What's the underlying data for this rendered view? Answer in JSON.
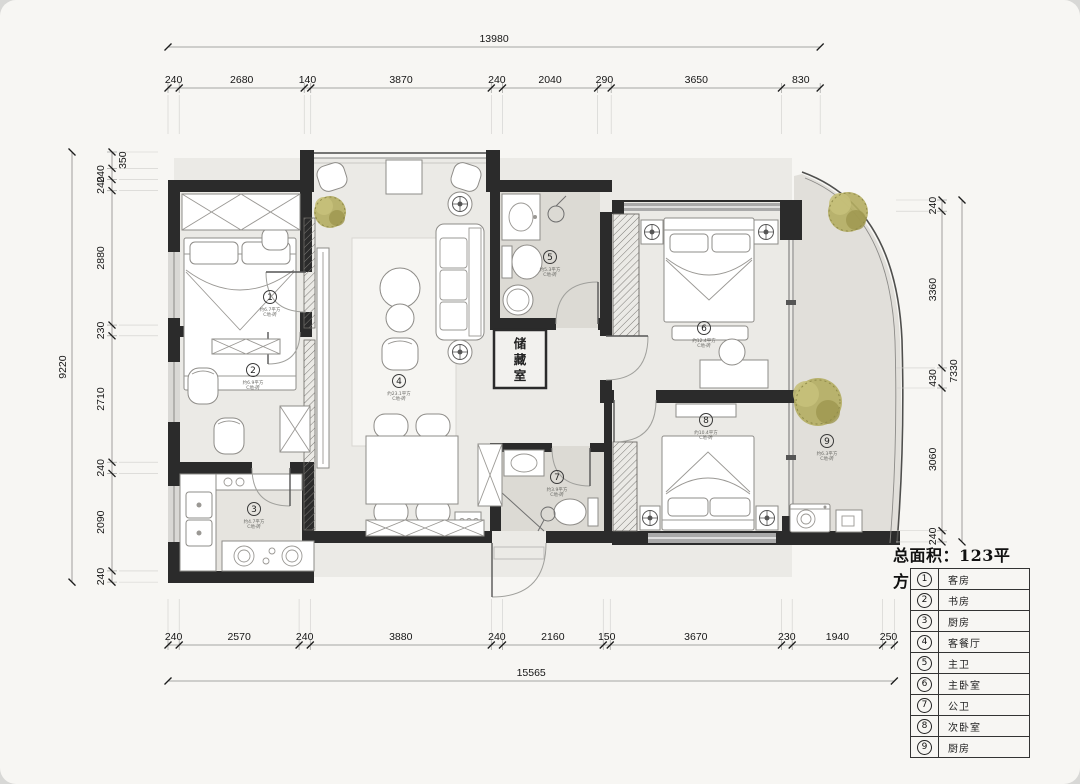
{
  "dimensions": {
    "top": {
      "overall": "13980",
      "segments": [
        "240",
        "2680",
        "140",
        "3870",
        "240",
        "2040",
        "290",
        "3650",
        "830"
      ]
    },
    "bottom": {
      "overall": "15565",
      "segments": [
        "240",
        "2570",
        "240",
        "3880",
        "240",
        "2160",
        "150",
        "3670",
        "230",
        "1940",
        "250"
      ]
    },
    "left": {
      "overall": "9220",
      "segments": [
        "350",
        "240",
        "240",
        "2880",
        "230",
        "2710",
        "240",
        "2090",
        "240"
      ]
    },
    "right": {
      "overall": "7330",
      "segments": [
        "240",
        "3360",
        "430",
        "3060",
        "240"
      ]
    }
  },
  "legend": {
    "total_line1": "总面积：123平",
    "total_line2": "方",
    "rows": [
      {
        "num": "1",
        "name": "客房"
      },
      {
        "num": "2",
        "name": "书房"
      },
      {
        "num": "3",
        "name": "厨房"
      },
      {
        "num": "4",
        "name": "客餐厅"
      },
      {
        "num": "5",
        "name": "主卫"
      },
      {
        "num": "6",
        "name": "主卧室"
      },
      {
        "num": "7",
        "name": "公卫"
      },
      {
        "num": "8",
        "name": "次卧室"
      },
      {
        "num": "9",
        "name": "厨房"
      }
    ]
  },
  "plan": {
    "storage_label": "储藏室",
    "room_labels": [
      {
        "num": "1",
        "area": "约6.7平方",
        "note": "C地·砖"
      },
      {
        "num": "2",
        "area": "约6.9平方",
        "note": "C地·砖"
      },
      {
        "num": "3",
        "area": "约4.7平方",
        "note": "C地·砖"
      },
      {
        "num": "4",
        "area": "约23.1平方",
        "note": "C地·砖"
      },
      {
        "num": "5",
        "area": "约5.3平方",
        "note": "C地·砖"
      },
      {
        "num": "6",
        "area": "约12.4平方",
        "note": "C地·砖"
      },
      {
        "num": "7",
        "area": "约3.9平方",
        "note": "C地·砖"
      },
      {
        "num": "8",
        "area": "约10.4平方",
        "note": "C地·砖"
      },
      {
        "num": "9",
        "area": "约6.3平方",
        "note": "C地·砖"
      }
    ]
  }
}
